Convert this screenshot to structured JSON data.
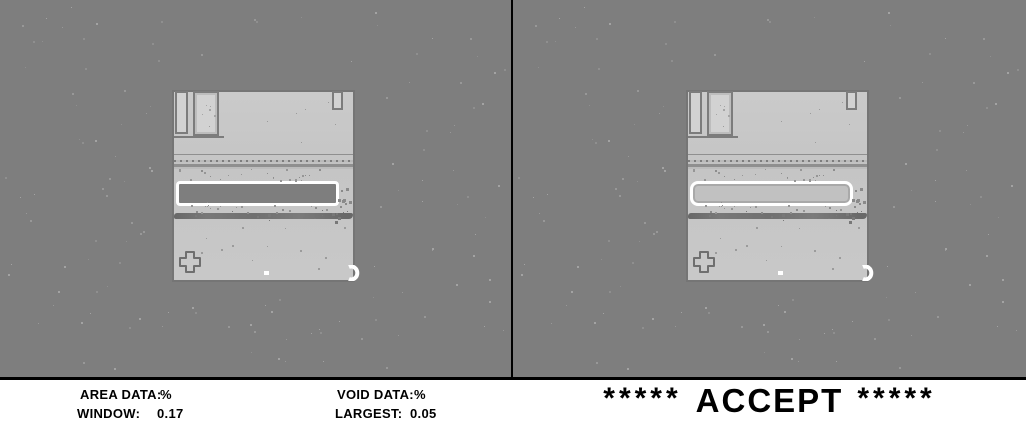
{
  "colors": {
    "background_gray": "#7e7e7e",
    "component_light": "#c7c7c7",
    "component_edge": "#757575",
    "window_outline": "#ffffff",
    "window_void_fill": "#7e7e7e",
    "window_solid_fill": "#c1c1c1",
    "solder_band": "#747474",
    "divider": "#000000",
    "statusbar_bg": "#ffffff",
    "text": "#000000"
  },
  "panels": {
    "left": {
      "name": "area-view"
    },
    "right": {
      "name": "void-view"
    }
  },
  "status_bar": {
    "measurements": {
      "columns": [
        {
          "rows": [
            {
              "label": "AREA DATA:",
              "value": "%"
            },
            {
              "label": "WINDOW:",
              "value": "0.17"
            }
          ]
        },
        {
          "rows": [
            {
              "label": "VOID DATA:",
              "value": "%"
            },
            {
              "label": "LARGEST:",
              "value": "0.05"
            }
          ]
        }
      ]
    },
    "result": {
      "stars_left": "*****",
      "text": "ACCEPT",
      "stars_right": "*****"
    }
  }
}
